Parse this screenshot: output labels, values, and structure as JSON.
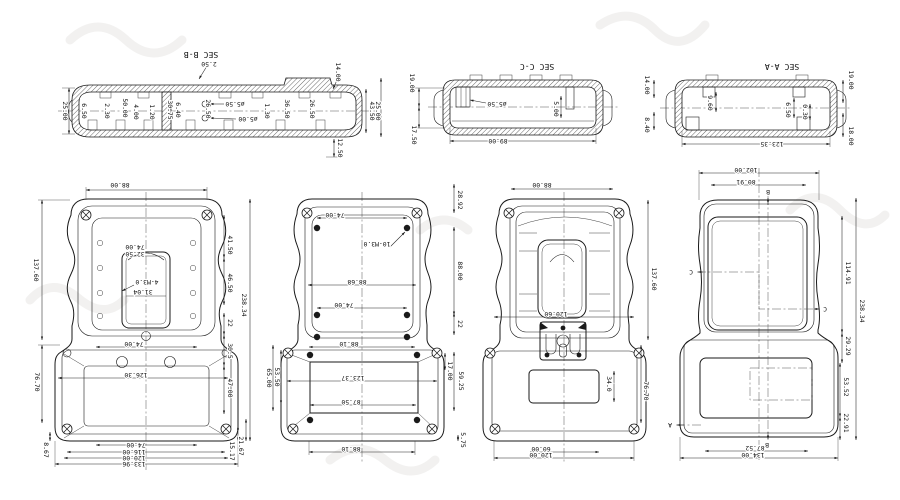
{
  "sec_bb": {
    "label": "SEC B-B",
    "d_2_50": "2.50",
    "d_25_00": "25.00",
    "d_6_50": "6.50",
    "d_2_30": "2.30",
    "d_50_00": "50.00",
    "d_4_00": "4.00",
    "d_1_20": "1.20",
    "d_30_75": "30.75",
    "d_6_40": "6.40",
    "d_26_50_a": "26.50",
    "dia_5_50": "ø5.50",
    "dia_5_00": "ø5.00",
    "d_1_30": "1.30",
    "d_36_50": "36.50",
    "d_26_50_b": "26.50",
    "d_14_00": "14.00",
    "d_43_50": "43.50",
    "d_25_00_b": "25.00",
    "d_12_50": "12.50"
  },
  "sec_cc": {
    "label": "SEC C-C",
    "d_19_00": "19.00",
    "d_17_50": "17.50",
    "dia_5_50": "ø5.50",
    "d_5_00": "5.00",
    "d_89_00": "89.00"
  },
  "sec_aa": {
    "label": "SEC A-A",
    "d_14_00": "14.00",
    "d_8_40": "8.40",
    "d_19_00": "19.00",
    "d_18_00": "18.00",
    "d_9_60": "9.60",
    "d_6_50": "6.50",
    "d_0_30": "0.30",
    "d_123_35": "123.35"
  },
  "view_bottom_case": {
    "d_88_00": "88.00",
    "d_137_60": "137.60",
    "d_76_70": "76.70",
    "d_8_67": "8.67",
    "d_41_50": "41.50",
    "d_46_50": "46.50",
    "d_22": "22",
    "d_30_5": "30.5",
    "d_47_00": "47.00",
    "d_238_34": "238.34",
    "d_21_67": "21.67",
    "d_15_17": "15.17",
    "d_74_00_slot": "74.00",
    "d_32_50": "32.50",
    "note_4_m3": "4-M3.0",
    "d_31_04": "31.04",
    "d_74_00_mid": "74.00",
    "d_126_30": "126.30",
    "d_74_00_b": "74.00",
    "d_116_00": "116.00",
    "d_120_00": "120.00",
    "d_133_96": "133.96"
  },
  "view_top_case_inside": {
    "d_74_00": "74.00",
    "note_10_m3": "10-M3.0",
    "d_88_68": "88.68",
    "d_74_00_b": "74.00",
    "d_88_10_a": "88.10",
    "d_123_37": "123.37",
    "d_87_50": "87.50",
    "d_88_10_b": "88.10",
    "d_28_92": "28.92",
    "d_88_00": "88.00",
    "d_22": "22",
    "d_17_00": "17.00",
    "d_59_25": "59.25",
    "d_5_75": "5.75",
    "d_53_50": "53.50",
    "d_65_00": "65.00"
  },
  "view_top_case_outside": {
    "d_88_00": "88.00",
    "d_137_60": "137.60",
    "d_76_70": "76.70",
    "d_120_60": "120.60",
    "d_34_0": "34.0",
    "d_60_00": "60.00",
    "d_120_00": "120.00"
  },
  "view_front": {
    "d_102_00": "102.00",
    "d_80_91": "80.91",
    "d_114_91": "114.91",
    "d_238_34": "238.34",
    "d_29_29": "29.29",
    "d_53_52": "53.52",
    "d_22_91": "22.91",
    "d_87_52": "87.52",
    "d_134_00": "134.00",
    "mark_b_top": "B",
    "mark_b_bottom": "B",
    "mark_c_left": "C",
    "mark_c_right": "C",
    "mark_a": "A"
  }
}
